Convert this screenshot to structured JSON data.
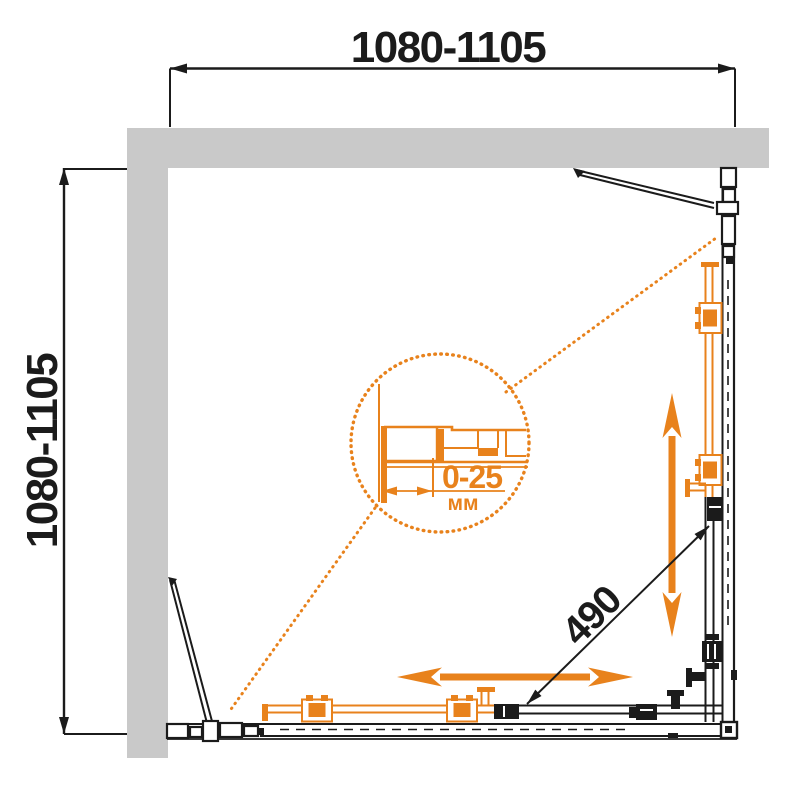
{
  "colors": {
    "accent": "#E8821C",
    "wall_fill": "#C9C9C9",
    "line": "#1B1B1B",
    "paper": "#FFFFFF"
  },
  "dimensions": {
    "top_width": "1080-1105",
    "left_depth": "1080-1105",
    "entry_diagonal": "490",
    "profile_adjustment": "0-25",
    "profile_adjustment_unit": "мм"
  }
}
